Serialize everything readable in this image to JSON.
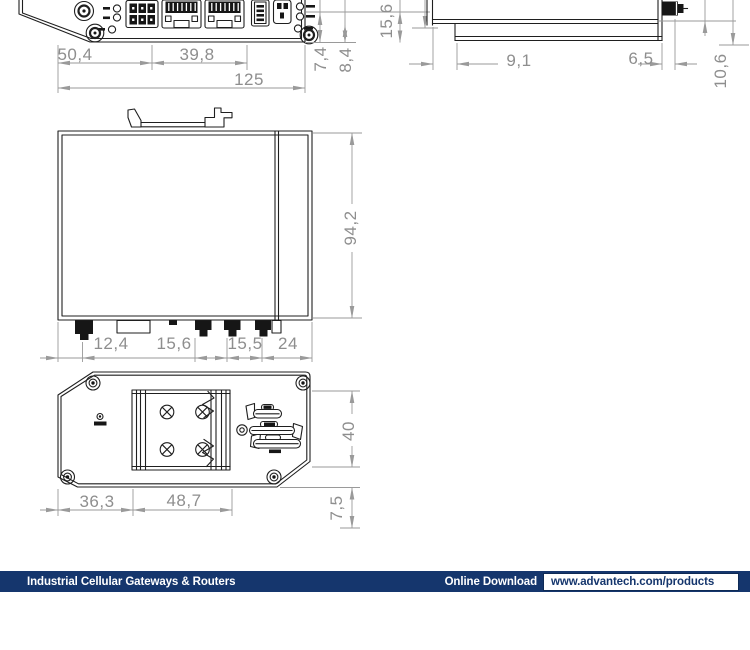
{
  "drawing": {
    "part_line_color": "#1f1f1f",
    "dimension_color": "#8e8e8e"
  },
  "dims": {
    "front_width_left": "50,4",
    "front_width_mid": "39,8",
    "front_width_total": "125",
    "front_v1": "7,4",
    "front_v2": "8,4",
    "front_v3": "15,6",
    "side_offset": "9,1",
    "side_right": "6,5",
    "side_conn_height": "10,6",
    "body_height": "94,2",
    "bottom_c1": "12,4",
    "bottom_c2": "15,6",
    "bottom_c3": "15,5",
    "bottom_c4": "24",
    "rear_left": "36,3",
    "rear_mid": "48,7",
    "rear_height": "40",
    "rear_clip": "7,5"
  },
  "footer": {
    "category": "Industrial Cellular Gateways & Routers",
    "download_label": "Online Download",
    "url": "www.advantech.com/products",
    "bar_color": "#15366d"
  }
}
